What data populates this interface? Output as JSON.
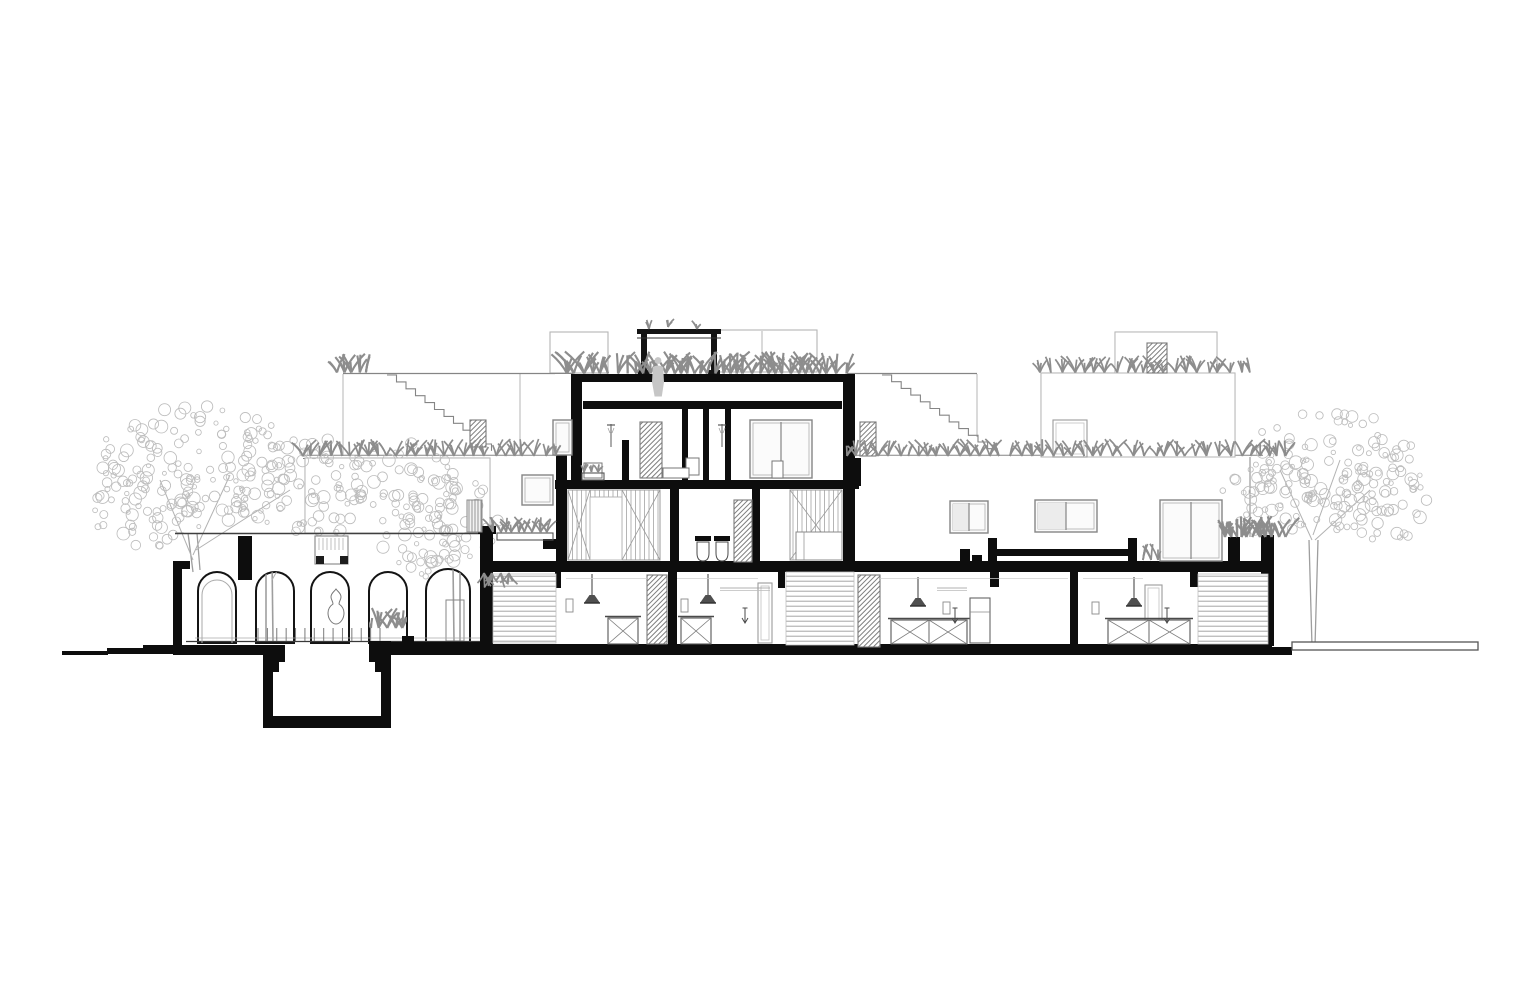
{
  "meta": {
    "kind": "architectural-section-elevation",
    "text_labels": []
  },
  "palette": {
    "paper": "#ffffff",
    "cut": "#0d0d0d",
    "strong": "#3f3f3f",
    "mid": "#858585",
    "faint": "#b5b5b5",
    "bg_line": "#cccccc",
    "foliage": "#8d8d8d",
    "tree": "#bdbdbd",
    "trunk": "#9e9e9e",
    "branch": "#b2b2b2",
    "figure": "#c6c6c6"
  },
  "drawing": {
    "white_masses": [
      [
        172,
        533,
        318,
        112
      ],
      [
        555,
        374,
        301,
        188
      ],
      [
        480,
        562,
        792,
        83
      ],
      [
        856,
        457,
        417,
        105
      ],
      [
        305,
        458,
        185,
        75
      ],
      [
        1041,
        373,
        194,
        84
      ],
      [
        1115,
        332,
        102,
        41
      ]
    ],
    "bg": {
      "faint_rects": [
        [
          550,
          332,
          58,
          41
        ],
        [
          713,
          330,
          104,
          42
        ],
        [
          1041,
          373,
          194,
          84
        ],
        [
          1115,
          332,
          102,
          41
        ],
        [
          1117,
          333,
          20,
          7
        ],
        [
          305,
          458,
          185,
          75
        ]
      ],
      "faint_lines": [
        [
          762,
          331,
          762,
          372
        ],
        [
          1250,
          457,
          1250,
          537
        ],
        [
          343,
          374,
          343,
          456
        ],
        [
          520,
          374,
          520,
          455
        ],
        [
          977,
          374,
          977,
          437
        ],
        [
          490,
          459,
          490,
          528
        ]
      ],
      "rooflines": [
        [
          343,
          373.5,
          573,
          373.5
        ],
        [
          847,
          373.5,
          977,
          373.5
        ]
      ],
      "terrace_lines": [
        [
          303,
          455.2,
          556,
          455.2
        ],
        [
          303,
          458.5,
          490,
          458.5
        ],
        [
          847,
          455.2,
          1263,
          455.2
        ],
        [
          847,
          458.5,
          1263,
          458.5
        ]
      ],
      "wall_top_outline": [
        176,
        533,
        7,
        28
      ]
    },
    "stairs": [
      {
        "x": 387,
        "y": 375,
        "n": 11,
        "dx": 9.5,
        "dy": 6.9
      },
      {
        "x": 882,
        "y": 375,
        "n": 12,
        "dx": 9.6,
        "dy": 6.7
      }
    ],
    "arcade": {
      "roof_line": [
        175,
        533.5,
        490,
        533.5
      ],
      "arches": [
        {
          "x": 198,
          "w": 38
        },
        {
          "x": 256,
          "w": 38
        },
        {
          "x": 311,
          "w": 38
        },
        {
          "x": 369,
          "w": 38
        },
        {
          "x": 426,
          "w": 44
        }
      ],
      "spring_y": 591,
      "floor_y": 643,
      "floor_lines": [
        [
          195,
          638,
          482,
          638
        ],
        [
          186,
          641.5,
          485,
          641.5
        ]
      ],
      "balusters": {
        "x0": 258,
        "x1": 380,
        "y0": 628,
        "y1": 641,
        "n": 14
      },
      "skylight": {
        "box": [
          315,
          536,
          33,
          28
        ],
        "feet": [
          [
            316,
            556,
            8,
            8
          ],
          [
            340,
            556,
            8,
            8
          ]
        ]
      },
      "statue_cx": 336,
      "door_arch": {
        "x0": 202,
        "x1": 232,
        "spring": 595,
        "r": 15
      }
    },
    "ground_rects": [
      [
        62,
        651,
        46,
        4
      ],
      [
        107,
        648,
        38,
        6
      ],
      [
        143,
        645,
        33,
        9
      ],
      [
        173,
        645,
        92,
        10
      ],
      [
        385,
        642,
        97,
        13
      ],
      [
        402,
        636,
        12,
        7
      ],
      [
        480,
        644,
        792,
        11
      ],
      [
        1266,
        647,
        26,
        8
      ]
    ],
    "pit_rects": [
      [
        263,
        645,
        22,
        17
      ],
      [
        263,
        662,
        16,
        10
      ],
      [
        263,
        672,
        10,
        46
      ],
      [
        369,
        641,
        22,
        21
      ],
      [
        375,
        662,
        16,
        10
      ],
      [
        381,
        672,
        10,
        46
      ],
      [
        263,
        716,
        128,
        12
      ]
    ],
    "right_ground_bar": [
      1292,
      642,
      186,
      8
    ],
    "cut_rects": [
      [
        173,
        561,
        17,
        8
      ],
      [
        173,
        569,
        9,
        81
      ],
      [
        238,
        536,
        14,
        44
      ],
      [
        571,
        374,
        281,
        8
      ],
      [
        583,
        401,
        259,
        8
      ],
      [
        571,
        374,
        11,
        107
      ],
      [
        556,
        455,
        11,
        117
      ],
      [
        543,
        539,
        14,
        10
      ],
      [
        843,
        374,
        12,
        190
      ],
      [
        853,
        458,
        8,
        28
      ],
      [
        555,
        480,
        304,
        9
      ],
      [
        480,
        561,
        792,
        11
      ],
      [
        682,
        408,
        6,
        73
      ],
      [
        703,
        408,
        6,
        73
      ],
      [
        725,
        408,
        6,
        73
      ],
      [
        622,
        440,
        7,
        41
      ],
      [
        670,
        489,
        9,
        73
      ],
      [
        752,
        489,
        8,
        73
      ],
      [
        668,
        572,
        9,
        73
      ],
      [
        1070,
        572,
        8,
        73
      ],
      [
        555,
        572,
        6,
        16
      ],
      [
        778,
        572,
        7,
        16
      ],
      [
        990,
        572,
        9,
        15
      ],
      [
        1190,
        572,
        8,
        15
      ],
      [
        480,
        528,
        13,
        122
      ],
      [
        478,
        526,
        18,
        8
      ],
      [
        1228,
        537,
        12,
        35
      ],
      [
        1261,
        535,
        13,
        111
      ],
      [
        695,
        536,
        16,
        5
      ],
      [
        714,
        536,
        16,
        5
      ]
    ],
    "pergola": {
      "posts": [
        [
          641,
          331,
          6,
          43
        ],
        [
          711,
          331,
          6,
          43
        ]
      ],
      "beam": [
        637,
        329,
        84,
        5
      ],
      "beam_line": [
        637,
        338,
        721,
        338
      ],
      "feet": [
        [
          638,
          370,
          12,
          4
        ],
        [
          708,
          370,
          12,
          4
        ]
      ]
    },
    "bench_rects": [
      [
        960,
        549,
        10,
        16
      ],
      [
        972,
        555,
        10,
        10
      ],
      [
        988,
        538,
        9,
        25
      ],
      [
        997,
        549,
        131,
        7
      ],
      [
        1128,
        538,
        9,
        25
      ]
    ],
    "hatched": [
      [
        640,
        422,
        22,
        56
      ],
      [
        734,
        500,
        18,
        62
      ],
      [
        470,
        420,
        16,
        27
      ],
      [
        860,
        422,
        16,
        34
      ],
      [
        1147,
        343,
        20,
        30
      ],
      [
        647,
        575,
        20,
        69
      ],
      [
        858,
        575,
        22,
        72
      ]
    ],
    "vert_hatched": [
      [
        467,
        500,
        15,
        32
      ]
    ],
    "louvers": [
      [
        493,
        574,
        63,
        69
      ],
      [
        786,
        572,
        68,
        73
      ],
      [
        1198,
        574,
        70,
        70
      ]
    ],
    "wardrobes": [
      {
        "r": [
          568,
          490,
          92,
          70
        ],
        "gap": [
          590,
          497,
          32,
          63
        ],
        "xpanels": [
          [
            568,
            590
          ],
          [
            622,
            660
          ]
        ]
      },
      {
        "r": [
          790,
          490,
          52,
          70
        ],
        "gap": null,
        "xpanels": [
          [
            790,
            842
          ]
        ]
      }
    ],
    "bed": [
      796,
      532,
      46,
      28
    ],
    "toilets": [
      703,
      722
    ],
    "windows": [
      {
        "r": [
          750,
          420,
          62,
          58
        ],
        "m": [
          781
        ],
        "tint": false
      },
      {
        "r": [
          553,
          420,
          19,
          35
        ],
        "m": [],
        "tint": false
      },
      {
        "r": [
          522,
          475,
          31,
          30
        ],
        "m": [],
        "tint": false
      },
      {
        "r": [
          950,
          501,
          38,
          32
        ],
        "m": [
          969
        ],
        "tint": true
      },
      {
        "r": [
          1035,
          500,
          62,
          32
        ],
        "m": [
          1066
        ],
        "tint": true
      },
      {
        "r": [
          1160,
          500,
          62,
          61
        ],
        "m": [
          1191
        ],
        "tint": false
      }
    ],
    "door_frames": [
      [
        758,
        583,
        14,
        60
      ],
      [
        1145,
        585,
        17,
        58
      ],
      [
        1053,
        420,
        34,
        37
      ]
    ],
    "pendants": [
      {
        "x": 592,
        "y": 574
      },
      {
        "x": 708,
        "y": 574
      },
      {
        "x": 918,
        "y": 577
      },
      {
        "x": 1134,
        "y": 577
      }
    ],
    "islands": [
      {
        "r": [
          608,
          618,
          30,
          26
        ],
        "cells": 1
      },
      {
        "r": [
          681,
          618,
          30,
          26
        ],
        "cells": 1
      },
      {
        "r": [
          891,
          620,
          76,
          24
        ],
        "cells": 2
      },
      {
        "r": [
          1108,
          620,
          82,
          24
        ],
        "cells": 2
      }
    ],
    "fridge": [
      970,
      598,
      20,
      45
    ],
    "wall_squares": [
      [
        566,
        599,
        7,
        13
      ],
      [
        681,
        599,
        7,
        13
      ],
      [
        943,
        602,
        7,
        12
      ],
      [
        1092,
        602,
        7,
        12
      ]
    ],
    "arrows": [
      745,
      955,
      1167
    ],
    "shelves": [
      [
        720,
        588,
        770
      ],
      [
        937,
        588,
        967
      ]
    ],
    "room_lines": [
      [
        566,
        578.5,
        647
      ],
      [
        677,
        578.5,
        758
      ],
      [
        880,
        578.5,
        1068
      ],
      [
        1083,
        578.5,
        1143
      ]
    ],
    "showers": [
      611,
      722
    ],
    "small_rects": [
      [
        686,
        458,
        13,
        17
      ],
      [
        663,
        468,
        26,
        10
      ],
      [
        584,
        463,
        18,
        15
      ],
      [
        772,
        461,
        11,
        17
      ]
    ],
    "planter_boxes": [
      [
        497,
        533,
        56,
        7
      ],
      [
        582,
        473,
        22,
        7
      ]
    ],
    "plant_rows": [
      {
        "x0": 567,
        "x1": 849,
        "y": 373.5,
        "s": 1.3,
        "step": 8
      },
      {
        "x0": 1040,
        "x1": 1252,
        "y": 372.5,
        "s": 1.0,
        "step": 10
      },
      {
        "x0": 847,
        "x1": 1292,
        "y": 456,
        "s": 1.0,
        "step": 10
      },
      {
        "x0": 303,
        "x1": 560,
        "y": 456,
        "s": 1.0,
        "step": 10
      },
      {
        "x0": 337,
        "x1": 367,
        "y": 372.5,
        "s": 1.2,
        "step": 7
      },
      {
        "x0": 493,
        "x1": 553,
        "y": 532,
        "s": 0.9,
        "step": 7
      },
      {
        "x0": 584,
        "x1": 602,
        "y": 472,
        "s": 0.6,
        "step": 6
      },
      {
        "x0": 1225,
        "x1": 1292,
        "y": 537,
        "s": 1.25,
        "step": 6
      },
      {
        "x0": 1143,
        "x1": 1165,
        "y": 560,
        "s": 1.0,
        "step": 7
      },
      {
        "x0": 484,
        "x1": 512,
        "y": 573,
        "s": -0.9,
        "step": 7
      }
    ],
    "sprigs": [
      [
        649,
        329
      ],
      [
        668,
        327
      ],
      [
        697,
        329
      ]
    ],
    "figure": {
      "cx": 658,
      "head_y": 360.5,
      "head_r": 3.4
    },
    "trees": [
      {
        "blobs": [
          [
            200,
            465,
            105,
            62
          ],
          [
            300,
            487,
            75,
            55
          ],
          [
            150,
            502,
            62,
            48
          ],
          [
            395,
            487,
            62,
            48
          ]
        ],
        "trunks": [
          [
            188,
            533,
            193,
            572
          ],
          [
            197,
            533,
            200,
            570
          ]
        ],
        "branches": [
          [
            193,
            560,
            160,
            480
          ],
          [
            193,
            555,
            230,
            475
          ],
          [
            196,
            550,
            290,
            490
          ]
        ]
      },
      {
        "blobs": [
          [
            445,
            520,
            58,
            46
          ],
          [
            420,
            546,
            40,
            33
          ]
        ],
        "trunks": [],
        "branches": []
      },
      {
        "blobs": [
          [
            1330,
            468,
            92,
            66
          ],
          [
            1268,
            500,
            48,
            42
          ],
          [
            1382,
            502,
            54,
            44
          ]
        ],
        "trunks": [
          [
            1309,
            540,
            1312,
            646
          ],
          [
            1318,
            540,
            1315,
            646
          ]
        ],
        "branches": [
          [
            1312,
            540,
            1280,
            470
          ],
          [
            1313,
            535,
            1340,
            460
          ],
          [
            1315,
            540,
            1370,
            490
          ]
        ]
      }
    ],
    "arch_clips": {
      "trunk_arch_idx2": [
        [
          266,
          560,
          266,
          641
        ],
        [
          272,
          558,
          273,
          641
        ]
      ],
      "trunk_arch_idx4": [
        [
          453,
          565,
          454,
          641
        ],
        [
          460,
          563,
          460,
          641
        ]
      ],
      "pot_arch_idx4": [
        446,
        600,
        18,
        41
      ],
      "foliage_arch_idx3": {
        "x0": 371,
        "x1": 404,
        "y": 628,
        "s": 1.2,
        "step": 7
      }
    }
  }
}
